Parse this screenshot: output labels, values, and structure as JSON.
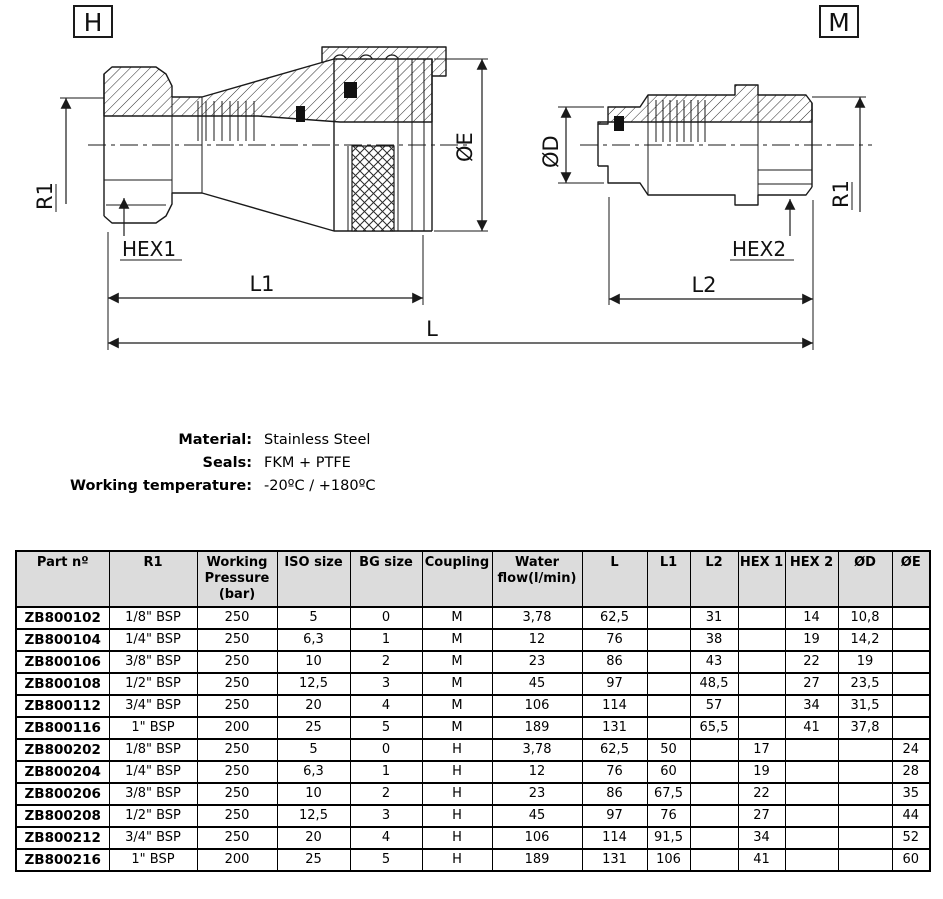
{
  "drawing": {
    "left_view": {
      "tag": "H",
      "dim_r1": "R1",
      "dim_hex": "HEX1",
      "dim_l1": "L1",
      "dim_oe": "ØE"
    },
    "right_view": {
      "tag": "M",
      "dim_od": "ØD",
      "dim_hex": "HEX2",
      "dim_l2": "L2",
      "dim_r1": "R1"
    },
    "dim_l": "L"
  },
  "specs": [
    {
      "label": "Material:",
      "value": "Stainless Steel"
    },
    {
      "label": "Seals:",
      "value": "FKM + PTFE"
    },
    {
      "label": "Working temperature:",
      "value": "-20ºC / +180ºC"
    }
  ],
  "table": {
    "headers": [
      "Part nº",
      "R1",
      "Working\nPressure\n(bar)",
      "ISO size",
      "BG size",
      "Coupling",
      "Water\nflow(l/min)",
      "L",
      "L1",
      "L2",
      "HEX 1",
      "HEX 2",
      "ØD",
      "ØE"
    ],
    "rows": [
      [
        "ZB800102",
        "1/8\" BSP",
        "250",
        "5",
        "0",
        "M",
        "3,78",
        "62,5",
        "",
        "31",
        "",
        "14",
        "10,8",
        ""
      ],
      [
        "ZB800104",
        "1/4\" BSP",
        "250",
        "6,3",
        "1",
        "M",
        "12",
        "76",
        "",
        "38",
        "",
        "19",
        "14,2",
        ""
      ],
      [
        "ZB800106",
        "3/8\" BSP",
        "250",
        "10",
        "2",
        "M",
        "23",
        "86",
        "",
        "43",
        "",
        "22",
        "19",
        ""
      ],
      [
        "ZB800108",
        "1/2\" BSP",
        "250",
        "12,5",
        "3",
        "M",
        "45",
        "97",
        "",
        "48,5",
        "",
        "27",
        "23,5",
        ""
      ],
      [
        "ZB800112",
        "3/4\" BSP",
        "250",
        "20",
        "4",
        "M",
        "106",
        "114",
        "",
        "57",
        "",
        "34",
        "31,5",
        ""
      ],
      [
        "ZB800116",
        "1\" BSP",
        "200",
        "25",
        "5",
        "M",
        "189",
        "131",
        "",
        "65,5",
        "",
        "41",
        "37,8",
        ""
      ],
      [
        "ZB800202",
        "1/8\" BSP",
        "250",
        "5",
        "0",
        "H",
        "3,78",
        "62,5",
        "50",
        "",
        "17",
        "",
        "",
        "24"
      ],
      [
        "ZB800204",
        "1/4\" BSP",
        "250",
        "6,3",
        "1",
        "H",
        "12",
        "76",
        "60",
        "",
        "19",
        "",
        "",
        "28"
      ],
      [
        "ZB800206",
        "3/8\" BSP",
        "250",
        "10",
        "2",
        "H",
        "23",
        "86",
        "67,5",
        "",
        "22",
        "",
        "",
        "35"
      ],
      [
        "ZB800208",
        "1/2\" BSP",
        "250",
        "12,5",
        "3",
        "H",
        "45",
        "97",
        "76",
        "",
        "27",
        "",
        "",
        "44"
      ],
      [
        "ZB800212",
        "3/4\" BSP",
        "250",
        "20",
        "4",
        "H",
        "106",
        "114",
        "91,5",
        "",
        "34",
        "",
        "",
        "52"
      ],
      [
        "ZB800216",
        "1\" BSP",
        "200",
        "25",
        "5",
        "H",
        "189",
        "131",
        "106",
        "",
        "41",
        "",
        "",
        "60"
      ]
    ]
  },
  "colors": {
    "header_bg": "#dcdcdc",
    "border": "#000000",
    "text": "#000000",
    "background": "#ffffff"
  }
}
